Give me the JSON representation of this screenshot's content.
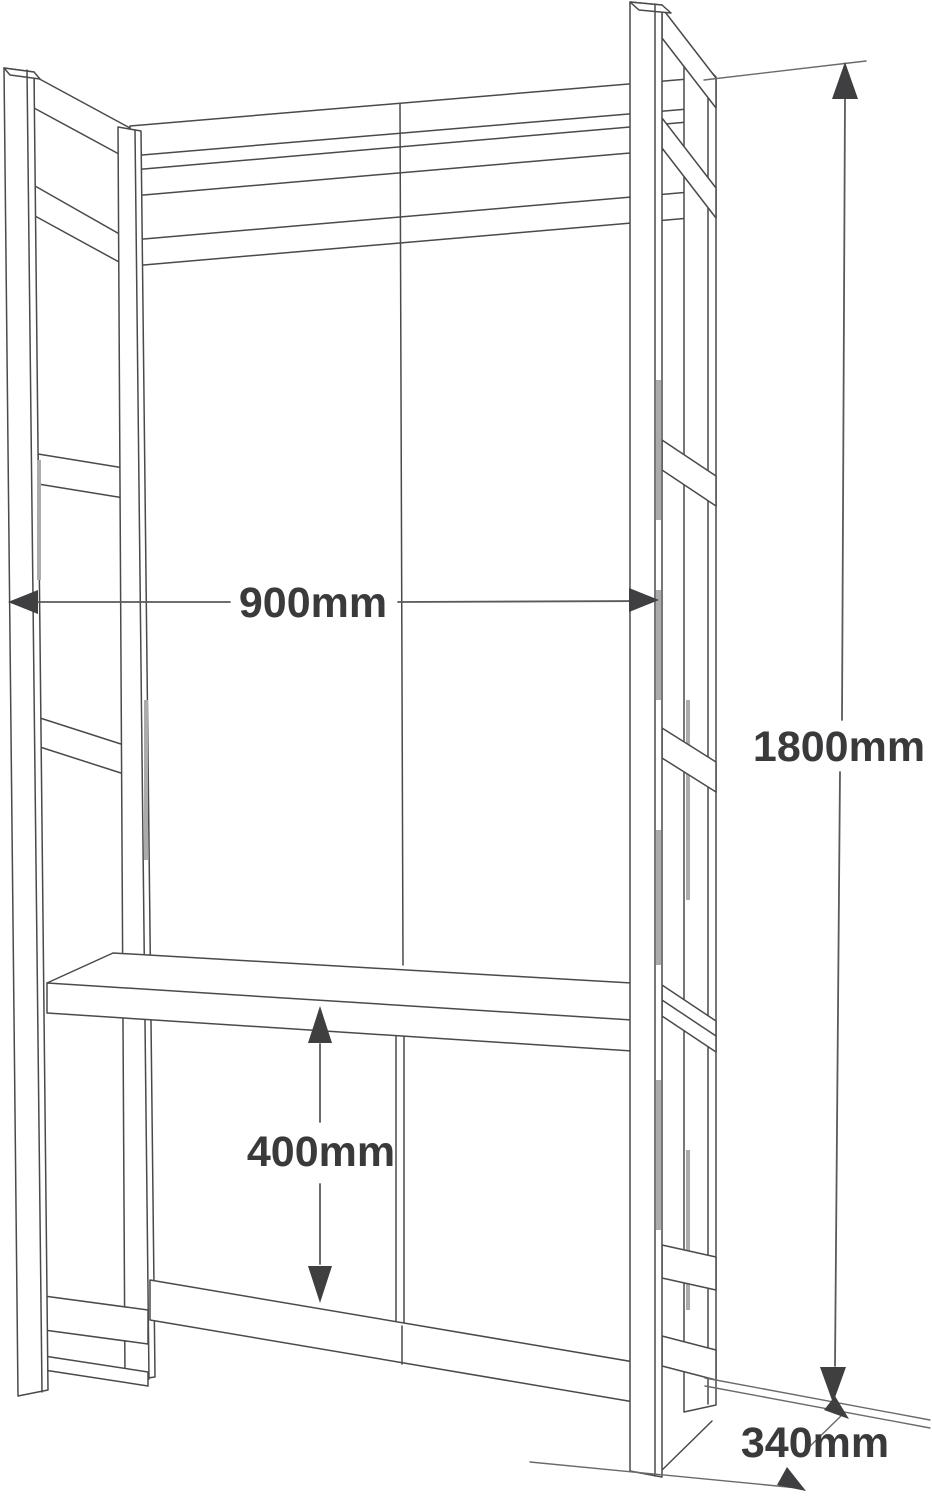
{
  "diagram": {
    "object": "open wardrobe shelving unit with lower cabinet - wireframe dimension drawing",
    "view": "3d-perspective-line-drawing",
    "dimensions": {
      "width": {
        "label": "900mm",
        "value": 900,
        "unit": "mm",
        "measures": "overall width between side frames"
      },
      "height": {
        "label": "1800mm",
        "value": 1800,
        "unit": "mm",
        "measures": "overall height of unit"
      },
      "cabinet_height": {
        "label": "400mm",
        "value": 400,
        "unit": "mm",
        "measures": "height of lower cabinet section"
      },
      "depth": {
        "label": "340mm",
        "value": 340,
        "unit": "mm",
        "measures": "overall depth of unit"
      }
    },
    "style": {
      "background": "#ffffff",
      "line_color": "#4a4a4a",
      "dimension_line_color": "#5a5a5a",
      "arrow_color": "#3f3f42",
      "text_color": "#3a3a3c",
      "shading_color": "#ababab"
    }
  }
}
